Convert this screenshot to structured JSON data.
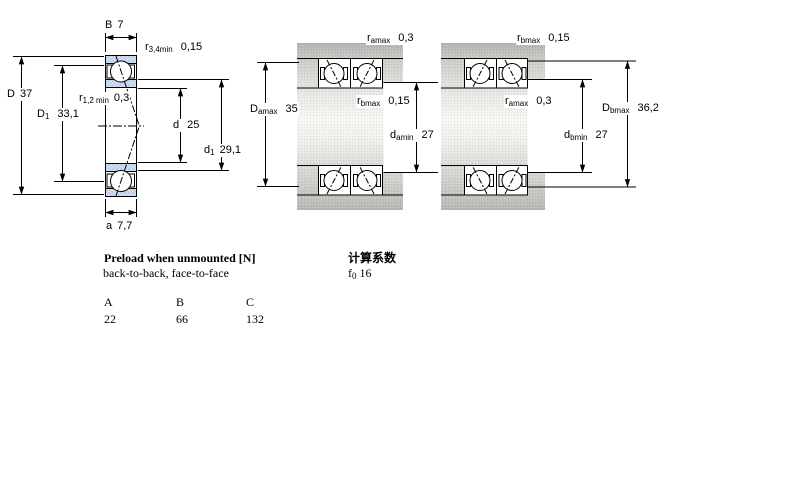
{
  "left_view": {
    "dims": {
      "B": {
        "base": "B",
        "value": "7"
      },
      "r34": {
        "base": "r",
        "sub": "3,4min",
        "value": "0,15"
      },
      "D": {
        "base": "D",
        "value": "37"
      },
      "D1": {
        "base": "D",
        "sub": "1",
        "value": "33,1"
      },
      "r12": {
        "base": "r",
        "sub": "1,2 min",
        "value": "0,3"
      },
      "d": {
        "base": "d",
        "value": "25"
      },
      "d1": {
        "base": "d",
        "sub": "1",
        "value": "29,1"
      },
      "a": {
        "base": "a",
        "value": "7,7"
      }
    }
  },
  "middle_view": {
    "dims": {
      "ramax": {
        "base": "r",
        "sub": "amax",
        "value": "0,3"
      },
      "Damax": {
        "base": "D",
        "sub": "amax",
        "value": "35"
      },
      "rbmax": {
        "base": "r",
        "sub": "bmax",
        "value": "0,15"
      },
      "damin": {
        "base": "d",
        "sub": "amin",
        "value": "27"
      }
    }
  },
  "right_view": {
    "dims": {
      "rbmax": {
        "base": "r",
        "sub": "bmax",
        "value": "0,15"
      },
      "ramax": {
        "base": "r",
        "sub": "amax",
        "value": "0,3"
      },
      "Dbmax": {
        "base": "D",
        "sub": "bmax",
        "value": "36,2"
      },
      "dbmin": {
        "base": "d",
        "sub": "bmin",
        "value": "27"
      }
    }
  },
  "preload": {
    "title": "Preload when unmounted [N]",
    "subtitle": "back-to-back, face-to-face",
    "columns": [
      "A",
      "B",
      "C"
    ],
    "values": [
      "22",
      "66",
      "132"
    ]
  },
  "calc": {
    "title": "计算系数",
    "factor_base": "f",
    "factor_sub": "0",
    "factor_value": "16"
  },
  "colors": {
    "line": "#000000",
    "ring_fill": "#cfddf1",
    "ring_dot": "#9db4d9",
    "steel_grey": "#c6c5c2",
    "background": "#ffffff"
  }
}
